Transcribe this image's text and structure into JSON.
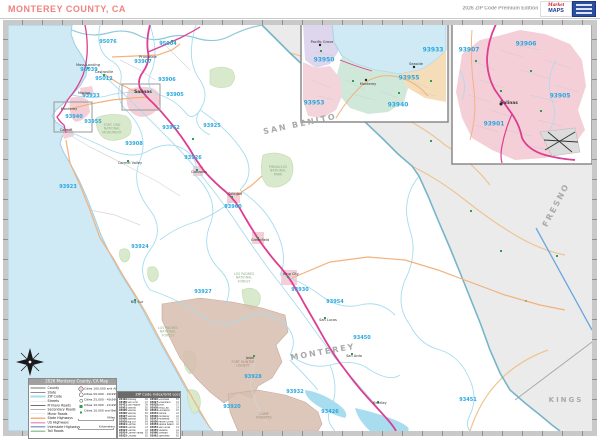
{
  "header": {
    "title": "MONTEREY COUNTY, CA",
    "edition": "2026 ZIP Code Premium Edition",
    "logo": {
      "word1": "Market",
      "word2": "MAPS"
    }
  },
  "colors": {
    "title_text": "#ee8480",
    "ocean": "#cfe9f5",
    "out_of_county": "#ebebeb",
    "zip_boundary": "#a6dcf0",
    "county_boundary": "#76b5c9",
    "us_highway": "#dd3d92",
    "state_highway": "#f2b27c",
    "park_green": "#d8e9cc",
    "military_tan": "#d7bdae",
    "urban_pink": "#f4cfd8",
    "zip_label": "#29a8de"
  },
  "map": {
    "county_labels": [
      {
        "text": "SAN BENITO",
        "x": 300,
        "y": 124,
        "rotate": -12
      },
      {
        "text": "FRESNO",
        "x": 556,
        "y": 205,
        "rotate": -62
      },
      {
        "text": "MONTEREY",
        "x": 323,
        "y": 352,
        "rotate": -10
      },
      {
        "text": "KINGS",
        "x": 566,
        "y": 400,
        "rotate": 0,
        "size": 7
      }
    ],
    "zip_labels": [
      {
        "z": "95076",
        "x": 108,
        "y": 42
      },
      {
        "z": "95004",
        "x": 168,
        "y": 44
      },
      {
        "z": "93907",
        "x": 143,
        "y": 62
      },
      {
        "z": "95039",
        "x": 89,
        "y": 70
      },
      {
        "z": "95012",
        "x": 104,
        "y": 79
      },
      {
        "z": "93906",
        "x": 167,
        "y": 80
      },
      {
        "z": "93905",
        "x": 175,
        "y": 95
      },
      {
        "z": "93933",
        "x": 91,
        "y": 96
      },
      {
        "z": "93940",
        "x": 74,
        "y": 117
      },
      {
        "z": "93955",
        "x": 93,
        "y": 122
      },
      {
        "z": "93962",
        "x": 171,
        "y": 128
      },
      {
        "z": "93925",
        "x": 212,
        "y": 126
      },
      {
        "z": "93908",
        "x": 134,
        "y": 144
      },
      {
        "z": "93926",
        "x": 193,
        "y": 158
      },
      {
        "z": "93923",
        "x": 68,
        "y": 187
      },
      {
        "z": "93960",
        "x": 233,
        "y": 207
      },
      {
        "z": "93924",
        "x": 140,
        "y": 247
      },
      {
        "z": "93927",
        "x": 203,
        "y": 292
      },
      {
        "z": "93930",
        "x": 300,
        "y": 290
      },
      {
        "z": "93954",
        "x": 335,
        "y": 302
      },
      {
        "z": "93450",
        "x": 362,
        "y": 338
      },
      {
        "z": "93928",
        "x": 253,
        "y": 377
      },
      {
        "z": "93932",
        "x": 295,
        "y": 392
      },
      {
        "z": "93920",
        "x": 232,
        "y": 407
      },
      {
        "z": "93426",
        "x": 330,
        "y": 412
      },
      {
        "z": "93451",
        "x": 468,
        "y": 400
      }
    ],
    "city_labels": [
      {
        "name": "Prunedale",
        "x": 148,
        "y": 57
      },
      {
        "name": "Moss Landing",
        "x": 88,
        "y": 65
      },
      {
        "name": "Castroville",
        "x": 104,
        "y": 72
      },
      {
        "name": "Marina",
        "x": 84,
        "y": 93
      },
      {
        "name": "Salinas",
        "x": 143,
        "y": 92,
        "big": true
      },
      {
        "name": "Monterey",
        "x": 69,
        "y": 109
      },
      {
        "name": "Carmel",
        "x": 66,
        "y": 130
      },
      {
        "name": "Carmel Valley",
        "x": 130,
        "y": 163
      },
      {
        "name": "Gonzales",
        "x": 199,
        "y": 172
      },
      {
        "name": "Soledad",
        "x": 235,
        "y": 194
      },
      {
        "name": "Greenfield",
        "x": 260,
        "y": 240
      },
      {
        "name": "King City",
        "x": 291,
        "y": 274
      },
      {
        "name": "San Lucas",
        "x": 328,
        "y": 320
      },
      {
        "name": "San Ardo",
        "x": 354,
        "y": 356
      },
      {
        "name": "Jolon",
        "x": 250,
        "y": 358
      },
      {
        "name": "Big Sur",
        "x": 137,
        "y": 302
      },
      {
        "name": "Bradley",
        "x": 380,
        "y": 403
      }
    ],
    "park_labels": [
      {
        "text": "Fort Ord National Monument",
        "x": 112,
        "y": 129,
        "w": 46
      },
      {
        "text": "Pinnacles National Park",
        "x": 278,
        "y": 171,
        "w": 44
      },
      {
        "text": "Los Padres National Forest",
        "x": 244,
        "y": 278,
        "w": 44
      },
      {
        "text": "Los Padres National Forest",
        "x": 168,
        "y": 332,
        "w": 44
      },
      {
        "text": "Fort Hunter Liggett",
        "x": 243,
        "y": 364,
        "w": 50,
        "mil": true
      },
      {
        "text": "Camp Roberts",
        "x": 264,
        "y": 416,
        "w": 40,
        "mil": true
      }
    ]
  },
  "insets": {
    "monterey": {
      "zip_labels": [
        {
          "z": "93950",
          "x": 324,
          "y": 60
        },
        {
          "z": "93933",
          "x": 433,
          "y": 50
        },
        {
          "z": "93955",
          "x": 409,
          "y": 78
        },
        {
          "z": "93940",
          "x": 398,
          "y": 105
        },
        {
          "z": "93953",
          "x": 314,
          "y": 103
        }
      ],
      "city_labels": [
        {
          "name": "Pacific Grove",
          "x": 322,
          "y": 42
        },
        {
          "name": "Monterey",
          "x": 368,
          "y": 84
        },
        {
          "name": "Seaside",
          "x": 416,
          "y": 64
        }
      ]
    },
    "salinas": {
      "zip_labels": [
        {
          "z": "93907",
          "x": 469,
          "y": 50
        },
        {
          "z": "93906",
          "x": 526,
          "y": 44
        },
        {
          "z": "93905",
          "x": 560,
          "y": 96
        },
        {
          "z": "93901",
          "x": 494,
          "y": 124
        }
      ],
      "city_labels": [
        {
          "name": "Salinas",
          "x": 509,
          "y": 103,
          "big": true
        }
      ]
    }
  },
  "legend": {
    "title": "2026 Monterey County, CA Map",
    "rows": [
      {
        "label": "County",
        "swatch": "county"
      },
      {
        "label": "State",
        "swatch": "state"
      },
      {
        "label": "ZIP Code",
        "swatch": "zip"
      },
      {
        "label": "Streets",
        "swatch": "streets"
      },
      {
        "label": "Primary Roads",
        "swatch": "primary"
      },
      {
        "label": "Secondary Roads",
        "swatch": "secondary"
      },
      {
        "label": "Minor Roads",
        "swatch": "minor"
      },
      {
        "label": "State Highways",
        "swatch": "state-hwy"
      },
      {
        "label": "US Highways",
        "swatch": "us-hwy"
      },
      {
        "label": "Interstate Highways",
        "swatch": "interstate"
      },
      {
        "label": "Toll Roads",
        "swatch": "toll"
      }
    ],
    "city_rows": [
      "Cities 100,000 and Above",
      "Cities 50,000 - 99,999",
      "Cities 25,000 - 49,999",
      "Cities 10,000 - 24,999",
      "Cities 10,000 and Below"
    ],
    "scale_miles": "Miles",
    "scale_km": "Kilometers"
  },
  "index_table": {
    "title": "ZIP Code Index/Grid Location",
    "entries": [
      {
        "zip": "93426",
        "name": "Bradley",
        "grid": "D6"
      },
      {
        "zip": "93450",
        "name": "San Ardo",
        "grid": "C5"
      },
      {
        "zip": "93451",
        "name": "San Miguel",
        "grid": "D6"
      },
      {
        "zip": "93901",
        "name": "Salinas",
        "grid": "B2"
      },
      {
        "zip": "93905",
        "name": "Salinas",
        "grid": "B2"
      },
      {
        "zip": "93906",
        "name": "Salinas",
        "grid": "B2"
      },
      {
        "zip": "93907",
        "name": "Salinas",
        "grid": "B1"
      },
      {
        "zip": "93908",
        "name": "Salinas",
        "grid": "B2"
      },
      {
        "zip": "93920",
        "name": "Big Sur",
        "grid": "B4"
      },
      {
        "zip": "93921",
        "name": "Carmel",
        "grid": "A3"
      },
      {
        "zip": "93922",
        "name": "Carmel",
        "grid": "A3"
      },
      {
        "zip": "93923",
        "name": "Carmel",
        "grid": "A3"
      },
      {
        "zip": "93924",
        "name": "Carmel Valley",
        "grid": "B3"
      },
      {
        "zip": "93925",
        "name": "Chualar",
        "grid": "B2"
      },
      {
        "zip": "93926",
        "name": "Gonzales",
        "grid": "B3"
      },
      {
        "zip": "93927",
        "name": "Greenfield",
        "grid": "C4"
      },
      {
        "zip": "93928",
        "name": "Jolon",
        "grid": "C5"
      },
      {
        "zip": "93930",
        "name": "King City",
        "grid": "C4"
      },
      {
        "zip": "93932",
        "name": "Lockwood",
        "grid": "C5"
      },
      {
        "zip": "93933",
        "name": "Marina",
        "grid": "A2"
      },
      {
        "zip": "93940",
        "name": "Monterey",
        "grid": "A2"
      },
      {
        "zip": "93943",
        "name": "Monterey",
        "grid": "A2"
      },
      {
        "zip": "93950",
        "name": "Pacific Grove",
        "grid": "A2"
      },
      {
        "zip": "93953",
        "name": "Pebble Beach",
        "grid": "A2"
      },
      {
        "zip": "93954",
        "name": "San Lucas",
        "grid": "C4"
      },
      {
        "zip": "93955",
        "name": "Seaside",
        "grid": "A2"
      },
      {
        "zip": "93960",
        "name": "Soledad",
        "grid": "B3"
      },
      {
        "zip": "93962",
        "name": "Spreckels",
        "grid": "B2"
      }
    ]
  }
}
